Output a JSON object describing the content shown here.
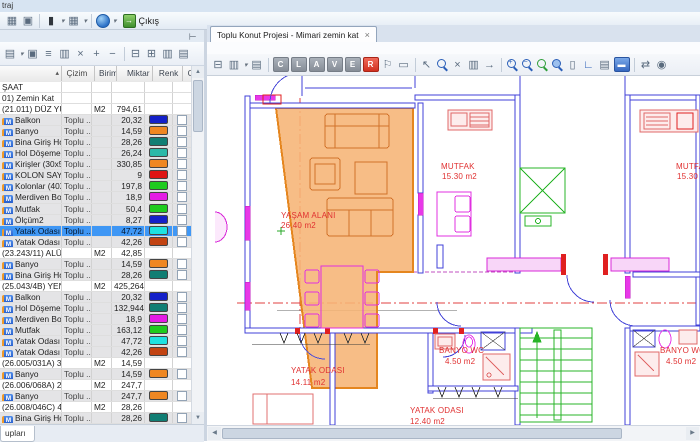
{
  "window": {
    "title_fragment": "traj"
  },
  "icons": {
    "scroll_up": "▲",
    "scroll_down": "▼",
    "scroll_left": "◀",
    "scroll_right": "▶",
    "pin": "⊥",
    "sort_asc": "▴",
    "tab_close": "×",
    "caret": "▾"
  },
  "main_toolbar": {
    "exit_label": "Çıkış",
    "items": [
      {
        "name": "window-icon",
        "glyph": "▦",
        "kind": "glyph"
      },
      {
        "name": "frame-icon",
        "glyph": "▣",
        "kind": "glyph"
      },
      {
        "name": "sep",
        "kind": "sep"
      },
      {
        "name": "book-icon",
        "glyph": "▮",
        "kind": "glyph-dark",
        "caret": true
      },
      {
        "name": "table-icon",
        "glyph": "▦",
        "kind": "glyph",
        "caret": true
      },
      {
        "name": "sep",
        "kind": "sep"
      },
      {
        "name": "help-globe-icon",
        "kind": "globe",
        "caret": true
      }
    ]
  },
  "left_panel": {
    "toolbar_items": [
      {
        "name": "paste-page-icon",
        "glyph": "▤",
        "kind": "glyph",
        "caret": true
      },
      {
        "name": "frame-select-icon",
        "glyph": "▣",
        "kind": "glyph"
      },
      {
        "name": "list-view-icon",
        "glyph": "≡",
        "kind": "glyph"
      },
      {
        "name": "copy-icon",
        "glyph": "▥",
        "kind": "glyph"
      },
      {
        "name": "delete-icon",
        "glyph": "×",
        "kind": "glyph"
      },
      {
        "name": "add-icon",
        "glyph": "+",
        "kind": "glyph"
      },
      {
        "name": "remove-icon",
        "glyph": "−",
        "kind": "glyph"
      },
      {
        "name": "sep",
        "kind": "sep"
      },
      {
        "name": "print-icon",
        "glyph": "⊟",
        "kind": "glyph"
      },
      {
        "name": "print-preview-icon",
        "glyph": "⊞",
        "kind": "glyph"
      },
      {
        "name": "copy-pages-icon",
        "glyph": "▥",
        "kind": "glyph"
      },
      {
        "name": "clipboard-icon",
        "glyph": "▤",
        "kind": "glyph"
      }
    ],
    "grid": {
      "columns": [
        "",
        "Çizim",
        "Birim",
        "Miktar",
        "Renk",
        "Gö..."
      ],
      "rows": [
        {
          "type": "group",
          "name": "ŞAAT"
        },
        {
          "type": "group",
          "name": "01) Zemin Kat"
        },
        {
          "type": "poz",
          "name": "(21.011) DÜZ YÜZ...",
          "birim": "M2",
          "miktar": "794,61"
        },
        {
          "type": "item",
          "name": "Balkon",
          "cizim": "Toplu ...",
          "miktar": "20,32",
          "color": "#1420C8"
        },
        {
          "type": "item",
          "name": "Banyo",
          "cizim": "Toplu ...",
          "miktar": "14,59",
          "color": "#EF8722"
        },
        {
          "type": "item",
          "name": "Bina Giriş Holü",
          "cizim": "Toplu ...",
          "miktar": "28,26",
          "color": "#117E74"
        },
        {
          "type": "item",
          "name": "Hol Döşeme",
          "cizim": "Toplu ...",
          "miktar": "26,24",
          "color": "#2CB9A8"
        },
        {
          "type": "item",
          "name": "Kirişler (30x50)",
          "cizim": "Toplu ...",
          "miktar": "330,85",
          "color": "#EF8722"
        },
        {
          "type": "item",
          "name": "KOLON SAYILARI",
          "cizim": "Toplu ...",
          "miktar": "9",
          "color": "#DE1414"
        },
        {
          "type": "item",
          "name": "Kolonlar (40X60)",
          "cizim": "Toplu ...",
          "miktar": "197,8",
          "color": "#1ECB1E"
        },
        {
          "type": "item",
          "name": "Merdiven Boşluğu",
          "cizim": "Toplu ...",
          "miktar": "18,9",
          "color": "#E41CE4"
        },
        {
          "type": "item",
          "name": "Mutfak",
          "cizim": "Toplu ...",
          "miktar": "50,4",
          "color": "#1ECB1E"
        },
        {
          "type": "item",
          "name": "Ölçüm2",
          "cizim": "Toplu ...",
          "miktar": "8,27",
          "color": "#1420C8"
        },
        {
          "type": "item",
          "name": "Yatak Odası",
          "cizim": "Toplu ...",
          "miktar": "47,72",
          "color": "#1EE1E1",
          "selected": true
        },
        {
          "type": "item",
          "name": "Yatak Odası 2",
          "cizim": "Toplu ...",
          "miktar": "42,26",
          "color": "#C24312"
        },
        {
          "type": "poz",
          "name": "(23.243/11) ALÜM...",
          "birim": "M2",
          "miktar": "42,85"
        },
        {
          "type": "item",
          "name": "Banyo",
          "cizim": "Toplu ...",
          "miktar": "14,59",
          "color": "#EF8722"
        },
        {
          "type": "item",
          "name": "Bina Giriş Holü",
          "cizim": "Toplu ...",
          "miktar": "28,26",
          "color": "#117E74"
        },
        {
          "type": "poz",
          "name": "(25.043/4B) YENİ ...",
          "birim": "M2",
          "miktar": "425,264"
        },
        {
          "type": "item",
          "name": "Balkon",
          "cizim": "Toplu ...",
          "miktar": "20,32",
          "color": "#1420C8"
        },
        {
          "type": "item",
          "name": "Hol Döşeme",
          "cizim": "Toplu ...",
          "miktar": "132,944",
          "color": "#117E74"
        },
        {
          "type": "item",
          "name": "Merdiven Boşluğu",
          "cizim": "Toplu ...",
          "miktar": "18,9",
          "color": "#E41CE4"
        },
        {
          "type": "item",
          "name": "Mutfak",
          "cizim": "Toplu ...",
          "miktar": "163,12",
          "color": "#1ECB1E"
        },
        {
          "type": "item",
          "name": "Yatak Odası",
          "cizim": "Toplu ...",
          "miktar": "47,72",
          "color": "#1EE1E1"
        },
        {
          "type": "item",
          "name": "Yatak Odası 2",
          "cizim": "Toplu ...",
          "miktar": "42,26",
          "color": "#C24312"
        },
        {
          "type": "poz",
          "name": "(26.005/031A) 33...",
          "birim": "M2",
          "miktar": "14,59"
        },
        {
          "type": "item",
          "name": "Banyo",
          "cizim": "Toplu ...",
          "miktar": "14,59",
          "color": "#EF8722"
        },
        {
          "type": "poz",
          "name": "(26.006/068A) 20...",
          "birim": "M2",
          "miktar": "247,7"
        },
        {
          "type": "item",
          "name": "Banyo",
          "cizim": "Toplu ...",
          "miktar": "247,7",
          "color": "#EF8722"
        },
        {
          "type": "poz",
          "name": "(26.008/046C) 40...",
          "birim": "M2",
          "miktar": "28,26"
        },
        {
          "type": "item",
          "name": "Bina Giriş Holü",
          "cizim": "Toplu ...",
          "miktar": "28,26",
          "color": "#117E74"
        }
      ]
    },
    "bottom_tab": "upları"
  },
  "drawing_panel": {
    "tab": {
      "title": "Toplu Konut Projesi - Mimari zemin kat"
    },
    "toolbar_items": [
      {
        "name": "print-icon",
        "glyph": "⊟",
        "kind": "glyph"
      },
      {
        "name": "copy-icon",
        "glyph": "▥",
        "kind": "glyph",
        "caret": true
      },
      {
        "name": "paste-icon",
        "glyph": "▤",
        "kind": "glyph"
      },
      {
        "name": "sep",
        "kind": "sep"
      },
      {
        "name": "layer-c-button",
        "glyph": "C",
        "kind": "chip"
      },
      {
        "name": "layer-l-button",
        "glyph": "L",
        "kind": "chip"
      },
      {
        "name": "layer-a-button",
        "glyph": "A",
        "kind": "chip"
      },
      {
        "name": "layer-v-button",
        "glyph": "V",
        "kind": "chip"
      },
      {
        "name": "layer-e-button",
        "glyph": "E",
        "kind": "chip"
      },
      {
        "name": "layer-r-button",
        "glyph": "R",
        "kind": "chip-red"
      },
      {
        "name": "flag-icon",
        "glyph": "⚐",
        "kind": "glyph"
      },
      {
        "name": "marquee-icon",
        "glyph": "▭",
        "kind": "glyph"
      },
      {
        "name": "sep",
        "kind": "sep"
      },
      {
        "name": "select-icon",
        "glyph": "↖",
        "kind": "glyph"
      },
      {
        "name": "zoom-window-icon",
        "kind": "mag"
      },
      {
        "name": "delete-icon",
        "glyph": "×",
        "kind": "glyph"
      },
      {
        "name": "pages-icon",
        "glyph": "▥",
        "kind": "glyph"
      },
      {
        "name": "go-icon",
        "glyph": "→",
        "kind": "glyph"
      },
      {
        "name": "sep",
        "kind": "sep"
      },
      {
        "name": "zoom-in-icon",
        "kind": "mag-plus"
      },
      {
        "name": "zoom-out-icon",
        "kind": "mag-minus"
      },
      {
        "name": "zoom-extents-icon",
        "kind": "mag-green"
      },
      {
        "name": "zoom-selection-icon",
        "kind": "mag-fill"
      },
      {
        "name": "sheet-icon",
        "glyph": "▯",
        "kind": "glyph"
      },
      {
        "name": "ruler-icon",
        "glyph": "∟",
        "kind": "glyph-blue"
      },
      {
        "name": "pages2-icon",
        "glyph": "▤",
        "kind": "glyph"
      },
      {
        "name": "viewport-icon",
        "glyph": "▬",
        "kind": "chip-blue"
      },
      {
        "name": "sep",
        "kind": "sep"
      },
      {
        "name": "swap-icon",
        "glyph": "⇄",
        "kind": "glyph"
      },
      {
        "name": "visibility-icon",
        "glyph": "◉",
        "kind": "glyph"
      }
    ],
    "labels": {
      "yasam": {
        "line1": "YAŞAM ALANI",
        "line2": "26.40 m2"
      },
      "mutfak1": {
        "line1": "MUTFAK",
        "line2": "15.30 m2"
      },
      "mutfak2": {
        "line1": "MUTFAK",
        "line2": "15.30 m2"
      },
      "banyo1": {
        "line1": "BANYO WC",
        "line2": "4.50 m2"
      },
      "banyo2": {
        "line1": "BANYO WC",
        "line2": "4.50 m2"
      },
      "yatak1": {
        "line1": "YATAK ODASI",
        "line2": "14.11 m2"
      },
      "yatak2": {
        "line1": "YATAK ODASI",
        "line2": "12.40 m2"
      }
    },
    "colors": {
      "highlight": "#F6B475",
      "highlight_border": "#E5861F",
      "wall": "#4040D8",
      "fixture_pink": "#E06868",
      "magenta": "#E030E0",
      "stairs_green": "#28B428",
      "label_red": "#E03030",
      "axis_red": "#E04040"
    }
  }
}
